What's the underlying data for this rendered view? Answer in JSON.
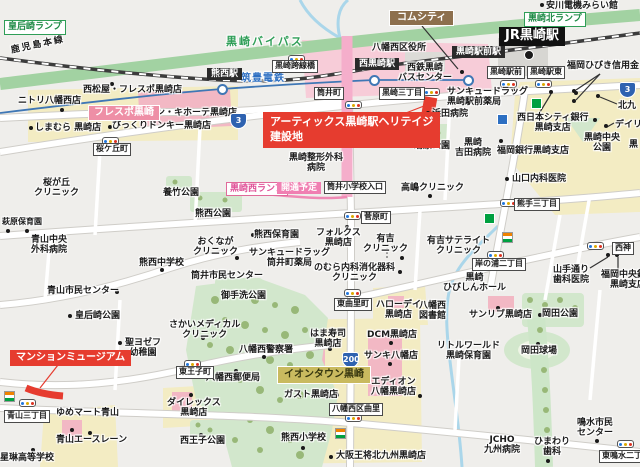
{
  "map": {
    "colors": {
      "background": "#efeeeb",
      "bypass_green": "#a2d2a2",
      "planned_road_pink": "#f5aecb",
      "highlight_red": "#e63c2f",
      "park_green": "#d2e7cc",
      "commercial_yellow": "#f3ecc3",
      "building_pink": "#f2b8c4",
      "water_blue": "#aad6ea",
      "tram_blue": "#3f77b5",
      "label_green": "#2f9e57",
      "label_brown": "#8d6f4d",
      "iontown_olive": "#c9ba5f"
    },
    "labels": [
      {
        "t": "皇后崎ランプ",
        "x": 4,
        "y": 20,
        "s": "g"
      },
      {
        "t": "黒崎北ランプ",
        "x": 524,
        "y": 12,
        "s": "g"
      },
      {
        "t": "黒崎バイパス",
        "x": 226,
        "y": 36,
        "s": "gt"
      },
      {
        "t": "鹿児島本線",
        "x": 10,
        "y": 46,
        "s": "rail"
      },
      {
        "t": "筑豊電鉄",
        "x": 241,
        "y": 73,
        "s": "bt"
      },
      {
        "t": "安川電機みらい館",
        "x": 546,
        "y": 1,
        "s": "p"
      },
      {
        "t": "JR黒崎駅",
        "x": 499,
        "y": 27,
        "s": "jr"
      },
      {
        "t": "コムシティ",
        "x": 389,
        "y": 10,
        "s": "br"
      },
      {
        "t": "八幡西区役所",
        "x": 372,
        "y": 43,
        "s": "p"
      },
      {
        "t": "黒崎駅前駅",
        "x": 452,
        "y": 46,
        "s": "b"
      },
      {
        "t": "西黒崎駅",
        "x": 355,
        "y": 58,
        "s": "b"
      },
      {
        "t": "熊西駅",
        "x": 207,
        "y": 68,
        "s": "b"
      },
      {
        "t": "黒崎跨線橋",
        "x": 272,
        "y": 60,
        "s": "w"
      },
      {
        "t": "西鉄黒崎\nバスセンター",
        "x": 398,
        "y": 63,
        "s": "pc"
      },
      {
        "t": "黒崎駅前",
        "x": 487,
        "y": 66,
        "s": "w"
      },
      {
        "t": "黒崎駅東",
        "x": 527,
        "y": 66,
        "s": "w"
      },
      {
        "t": "福岡ひびき信用金",
        "x": 567,
        "y": 61,
        "s": "p"
      },
      {
        "t": "筒井町",
        "x": 314,
        "y": 87,
        "s": "w"
      },
      {
        "t": "黒崎三丁目",
        "x": 379,
        "y": 87,
        "s": "w"
      },
      {
        "t": "サンキュードラッグ\n黒崎駅前薬局",
        "x": 447,
        "y": 87,
        "s": "p"
      },
      {
        "t": "浜田病院",
        "x": 432,
        "y": 109,
        "s": "p"
      },
      {
        "t": "西日本シティ銀行\n黒崎支店",
        "x": 517,
        "y": 113,
        "s": "pc"
      },
      {
        "t": "北九",
        "x": 618,
        "y": 101,
        "s": "p"
      },
      {
        "t": "デイリ",
        "x": 615,
        "y": 120,
        "s": "p"
      },
      {
        "t": "黒",
        "x": 629,
        "y": 140,
        "s": "p"
      },
      {
        "t": "黒崎中央\n公園",
        "x": 584,
        "y": 133,
        "s": "pc"
      },
      {
        "t": "福岡銀行黒崎支店",
        "x": 497,
        "y": 146,
        "s": "p"
      },
      {
        "t": "山口内科医院",
        "x": 512,
        "y": 174,
        "s": "p"
      },
      {
        "t": "熊手三丁目",
        "x": 514,
        "y": 198,
        "s": "w"
      },
      {
        "t": "ニトリ八幡西店",
        "x": 18,
        "y": 96,
        "s": "p"
      },
      {
        "t": "西松屋・フレスポ黒崎店",
        "x": 83,
        "y": 85,
        "s": "p"
      },
      {
        "t": "フレスポ黒崎",
        "x": 88,
        "y": 105,
        "s": "pb"
      },
      {
        "t": "ドン・キホーテ黒崎店",
        "x": 147,
        "y": 108,
        "s": "p"
      },
      {
        "t": "しまむら 黒崎店",
        "x": 35,
        "y": 123,
        "s": "p"
      },
      {
        "t": "びっくりドンキー黒崎店",
        "x": 112,
        "y": 121,
        "s": "p"
      },
      {
        "t": "桜ケ丘町",
        "x": 93,
        "y": 143,
        "s": "w"
      },
      {
        "t": "アーティックス黒崎駅ヘリテイジ\n建設地",
        "x": 263,
        "y": 112,
        "s": "rl"
      },
      {
        "t": "黒崎整形外科\n病院",
        "x": 289,
        "y": 153,
        "s": "pc"
      },
      {
        "t": "蛎原公園",
        "x": 414,
        "y": 141,
        "s": "p"
      },
      {
        "t": "黒崎\n吉田病院",
        "x": 455,
        "y": 138,
        "s": "pc"
      },
      {
        "t": "黒崎西ランプ",
        "x": 226,
        "y": 182,
        "s": "po"
      },
      {
        "t": "開通予定",
        "x": 277,
        "y": 182,
        "s": "pf"
      },
      {
        "t": "筒井小学校入口",
        "x": 324,
        "y": 181,
        "s": "w"
      },
      {
        "t": "高嶋クリニック",
        "x": 401,
        "y": 183,
        "s": "p"
      },
      {
        "t": "桜が丘\nクリニック",
        "x": 34,
        "y": 178,
        "s": "pc"
      },
      {
        "t": "養竹公園",
        "x": 163,
        "y": 188,
        "s": "p"
      },
      {
        "t": "熊西公園",
        "x": 195,
        "y": 209,
        "s": "p"
      },
      {
        "t": "菅原町",
        "x": 361,
        "y": 211,
        "s": "w"
      },
      {
        "t": "萩原保育園",
        "x": 2,
        "y": 217,
        "s": "ps"
      },
      {
        "t": "青山中央\n外科病院",
        "x": 31,
        "y": 235,
        "s": "pc"
      },
      {
        "t": "熊西中学校",
        "x": 139,
        "y": 258,
        "s": "p"
      },
      {
        "t": "おくなが\nクリニック",
        "x": 193,
        "y": 237,
        "s": "pc"
      },
      {
        "t": "熊西保育園",
        "x": 254,
        "y": 230,
        "s": "p"
      },
      {
        "t": "フォルクス\n黒崎店",
        "x": 316,
        "y": 228,
        "s": "pc"
      },
      {
        "t": "有吉\nクリニック",
        "x": 363,
        "y": 234,
        "s": "pc"
      },
      {
        "t": "サンキュードラッグ\n筒井町薬局",
        "x": 249,
        "y": 248,
        "s": "pc"
      },
      {
        "t": "のむら内科消化器科\nクリニック",
        "x": 314,
        "y": 263,
        "s": "pc"
      },
      {
        "t": "筒井市民センター",
        "x": 191,
        "y": 271,
        "s": "p"
      },
      {
        "t": "御手洗公園",
        "x": 221,
        "y": 291,
        "s": "p"
      },
      {
        "t": "青山市民センター",
        "x": 47,
        "y": 286,
        "s": "p"
      },
      {
        "t": "皇后崎公園",
        "x": 75,
        "y": 311,
        "s": "p"
      },
      {
        "t": "有吉サテライト\nクリニック",
        "x": 427,
        "y": 236,
        "s": "pc"
      },
      {
        "t": "東曲里町",
        "x": 334,
        "y": 298,
        "s": "w"
      },
      {
        "t": "岸の浦二丁目",
        "x": 472,
        "y": 258,
        "s": "w"
      },
      {
        "t": "ハローデイ\n黒崎店",
        "x": 376,
        "y": 300,
        "s": "pc"
      },
      {
        "t": "山手通り\n歯科医院",
        "x": 553,
        "y": 265,
        "s": "pc"
      },
      {
        "t": "西神",
        "x": 612,
        "y": 242,
        "s": "w"
      },
      {
        "t": "福岡中央銀行\n黒崎支店",
        "x": 601,
        "y": 270,
        "s": "pc"
      },
      {
        "t": "黒崎\nひびしんホール",
        "x": 443,
        "y": 273,
        "s": "pc"
      },
      {
        "t": "八幡西\n図書館",
        "x": 419,
        "y": 301,
        "s": "pc"
      },
      {
        "t": "サンリブ黒崎店",
        "x": 469,
        "y": 310,
        "s": "p"
      },
      {
        "t": "岡田公園",
        "x": 542,
        "y": 309,
        "s": "p"
      },
      {
        "t": "岡田球場",
        "x": 521,
        "y": 346,
        "s": "p"
      },
      {
        "t": "リトルワールド\n黒崎保育園",
        "x": 437,
        "y": 341,
        "s": "pc"
      },
      {
        "t": "さかいメディカル\nクリニック",
        "x": 169,
        "y": 320,
        "s": "pc"
      },
      {
        "t": "聖ヨゼフ\n幼稚園",
        "x": 125,
        "y": 338,
        "s": "pc"
      },
      {
        "t": "マンションミュージアム",
        "x": 10,
        "y": 350,
        "s": "rs"
      },
      {
        "t": "東王子町",
        "x": 176,
        "y": 366,
        "s": "w"
      },
      {
        "t": "八幡西警察署",
        "x": 239,
        "y": 345,
        "s": "p"
      },
      {
        "t": "八幡西郵便局",
        "x": 206,
        "y": 373,
        "s": "p"
      },
      {
        "t": "はま寿司\n黒崎店",
        "x": 310,
        "y": 329,
        "s": "pc"
      },
      {
        "t": "DCM黒崎店",
        "x": 367,
        "y": 330,
        "s": "p"
      },
      {
        "t": "サンキ八幡店",
        "x": 364,
        "y": 351,
        "s": "p"
      },
      {
        "t": "イオンタウン黒崎",
        "x": 277,
        "y": 366,
        "s": "ol"
      },
      {
        "t": "エディオン\n八幡黒崎店",
        "x": 371,
        "y": 377,
        "s": "pc"
      },
      {
        "t": "ガスト黒崎店",
        "x": 284,
        "y": 390,
        "s": "p"
      },
      {
        "t": "八幡西区曲里",
        "x": 329,
        "y": 403,
        "s": "w"
      },
      {
        "t": "ダイレックス\n黒崎店",
        "x": 167,
        "y": 398,
        "s": "pc"
      },
      {
        "t": "西王子公園",
        "x": 180,
        "y": 436,
        "s": "p"
      },
      {
        "t": "青山三丁目",
        "x": 4,
        "y": 410,
        "s": "w"
      },
      {
        "t": "ゆめマート青山",
        "x": 56,
        "y": 408,
        "s": "p"
      },
      {
        "t": "青山エースレーン",
        "x": 56,
        "y": 435,
        "s": "p"
      },
      {
        "t": "星琳高等学校",
        "x": 0,
        "y": 453,
        "s": "p"
      },
      {
        "t": "熊西小学校",
        "x": 281,
        "y": 433,
        "s": "p"
      },
      {
        "t": "大阪王将北九州黒崎店",
        "x": 336,
        "y": 451,
        "s": "p"
      },
      {
        "t": "鳴水市民\nセンター",
        "x": 577,
        "y": 418,
        "s": "pc"
      },
      {
        "t": "JCHO\n九州病院",
        "x": 484,
        "y": 435,
        "s": "pc"
      },
      {
        "t": "ひまわり\n歯科",
        "x": 534,
        "y": 437,
        "s": "pc"
      },
      {
        "t": "東鳴水二丁目",
        "x": 599,
        "y": 450,
        "s": "w"
      }
    ],
    "poi_dots": [
      [
        542,
        5
      ],
      [
        112,
        84
      ],
      [
        62,
        110
      ],
      [
        152,
        107
      ],
      [
        110,
        127
      ],
      [
        31,
        128
      ],
      [
        428,
        113
      ],
      [
        574,
        91
      ],
      [
        574,
        101
      ],
      [
        598,
        96
      ],
      [
        606,
        126
      ],
      [
        595,
        120
      ],
      [
        551,
        92
      ],
      [
        576,
        93
      ],
      [
        501,
        141
      ],
      [
        507,
        179
      ],
      [
        462,
        72
      ],
      [
        448,
        148
      ],
      [
        430,
        196
      ],
      [
        430,
        139
      ],
      [
        253,
        235
      ],
      [
        237,
        258
      ],
      [
        402,
        258
      ],
      [
        400,
        272
      ],
      [
        347,
        227
      ],
      [
        162,
        270
      ],
      [
        117,
        292
      ],
      [
        70,
        316
      ],
      [
        8,
        231
      ],
      [
        27,
        231
      ],
      [
        203,
        338
      ],
      [
        120,
        343
      ],
      [
        264,
        357
      ],
      [
        236,
        371
      ],
      [
        330,
        349
      ],
      [
        391,
        343
      ],
      [
        390,
        364
      ],
      [
        420,
        396
      ],
      [
        337,
        395
      ],
      [
        331,
        457
      ],
      [
        303,
        448
      ],
      [
        201,
        435
      ],
      [
        191,
        395
      ],
      [
        72,
        430
      ],
      [
        90,
        433
      ],
      [
        33,
        450
      ],
      [
        597,
        441
      ],
      [
        548,
        461
      ],
      [
        498,
        308
      ],
      [
        540,
        315
      ],
      [
        538,
        344
      ],
      [
        472,
        273
      ],
      [
        608,
        255
      ],
      [
        617,
        255
      ]
    ],
    "traffic_lights": [
      [
        109,
        140
      ],
      [
        295,
        58
      ],
      [
        352,
        104
      ],
      [
        430,
        91
      ],
      [
        351,
        215
      ],
      [
        351,
        292
      ],
      [
        507,
        83
      ],
      [
        542,
        83
      ],
      [
        507,
        202
      ],
      [
        494,
        254
      ],
      [
        594,
        245
      ],
      [
        191,
        363
      ],
      [
        26,
        402
      ],
      [
        352,
        417
      ],
      [
        624,
        443
      ]
    ],
    "store_icons": [
      {
        "x": 506,
        "y": 236,
        "type": "seven-eleven-icon"
      },
      {
        "x": 8,
        "y": 395,
        "type": "seven-eleven-icon"
      },
      {
        "x": 339,
        "y": 432,
        "type": "seven-eleven-icon"
      },
      {
        "x": 488,
        "y": 217,
        "type": "green-store-icon"
      },
      {
        "x": 535,
        "y": 102,
        "type": "green-store-icon"
      },
      {
        "x": 501,
        "y": 118,
        "type": "blue-store-icon"
      }
    ],
    "route_shields": [
      {
        "x": 230,
        "y": 113,
        "num": "3"
      },
      {
        "x": 619,
        "y": 82,
        "num": "3"
      },
      {
        "x": 342,
        "y": 352,
        "num": "200"
      }
    ],
    "tram_stations": [
      [
        222,
        89
      ],
      [
        374,
        80
      ],
      [
        468,
        80
      ]
    ],
    "jr_station_dot": [
      529,
      55
    ]
  }
}
